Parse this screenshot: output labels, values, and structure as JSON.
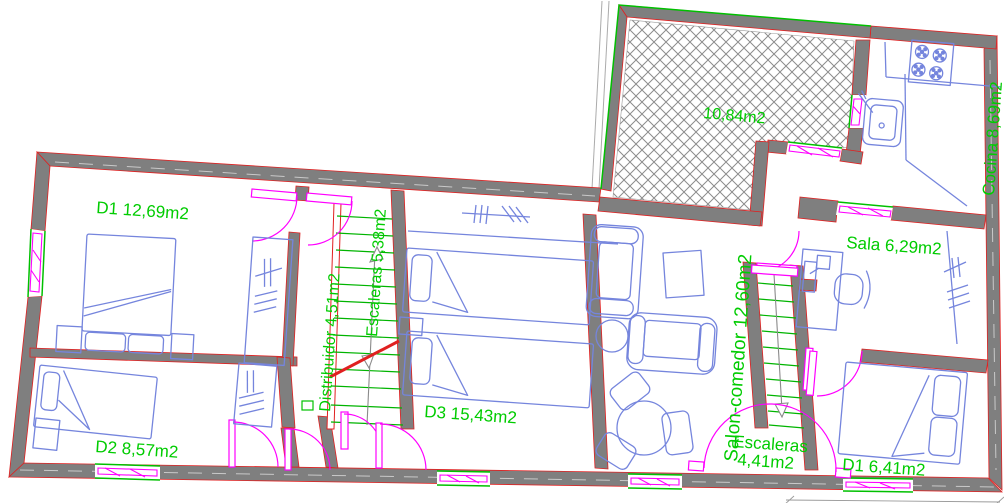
{
  "drawing_type": "architectural-floor-plan",
  "colors": {
    "wall_fill": "#7f7f7f",
    "wall_edge": "#e02020",
    "furniture": "#7585dd",
    "label_green": "#00cc00",
    "opening": "#ff00ff",
    "sill": "#00c000",
    "stair_tread": "#00b400",
    "hatch_gray": "#8c8c8c"
  },
  "labels": {
    "room_d1_left": "D1 12,69m2",
    "room_d2": "D2 8,57m2",
    "room_d3": "D3 15,43m2",
    "corridor": "Distribuidor 4,51m2",
    "stairs_main": "Escaleras 5,38m2",
    "living_room": "Salon-comedor 12,60m2",
    "stairs_small_name": "Escaleras",
    "stairs_small_area": "4,41m2",
    "office": "Sala 6,29m2",
    "kitchen": "Cocina 8,69m2",
    "room_d1_right": "D1 6,41m2",
    "terrace_area": "10,84m2"
  }
}
